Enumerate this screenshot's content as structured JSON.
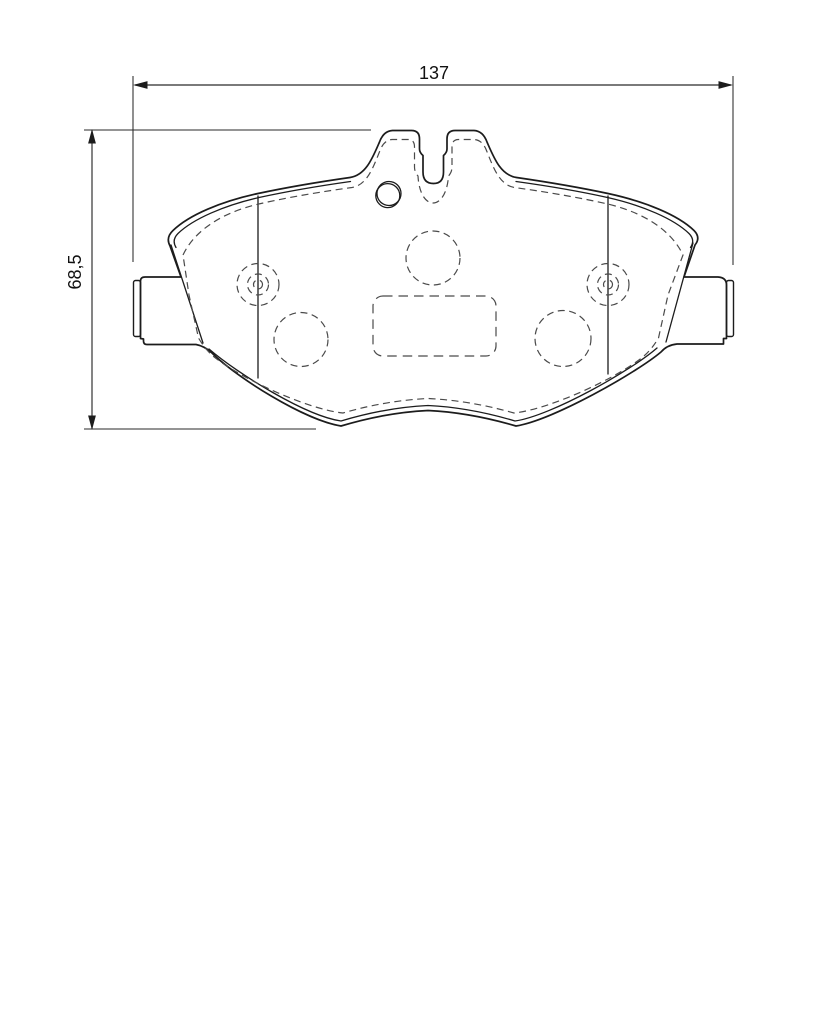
{
  "drawing": {
    "subject": "brake-pad-backing-plate-technical-drawing",
    "dimensions": {
      "width": {
        "label": "137"
      },
      "height": {
        "label": "68,5"
      }
    },
    "colors": {
      "line": "#1c1c1c",
      "dashed_line": "#4a4a4a",
      "background": "#ffffff"
    }
  }
}
